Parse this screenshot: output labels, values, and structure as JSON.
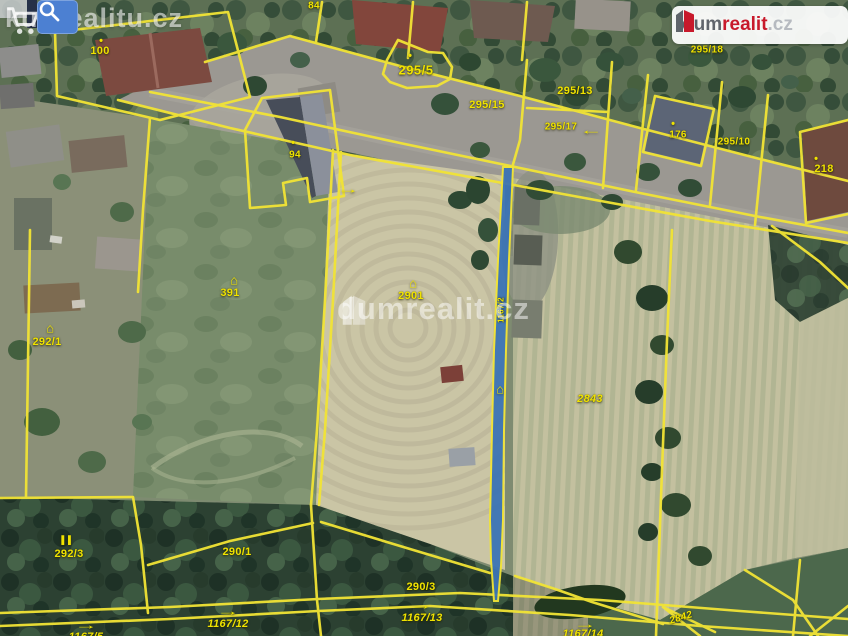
{
  "page": {
    "title": "Cadastral aerial map with parcel overlay"
  },
  "branding": {
    "watermark_top_left": "kuprealitu.cz",
    "watermark_center": "dumrealit.cz",
    "logo": {
      "part_gray": "dum",
      "part_red": "realit",
      "part_tld": ".cz"
    },
    "colors": {
      "logo_red": "#c8192b",
      "logo_gray": "#5f646b",
      "logo_tld_gray": "#b6bac0"
    }
  },
  "toolbar": {
    "search_button": "search"
  },
  "map": {
    "colors": {
      "boundary_yellow": "#f2e435",
      "highlight_blue": "#3c74b5",
      "label_yellow": "#f0e300"
    },
    "highlighted_parcel": "1167/2",
    "symbols": {
      "house": "⌂",
      "dot": "•",
      "arrow_right": "→",
      "arrow_left": "←",
      "forest": "▌▌"
    },
    "labels": {
      "p100": "100",
      "p84": "84",
      "p94": "94",
      "p295_5": "295/5",
      "p295_15": "295/15",
      "p295_13": "295/13",
      "p295_17": "295/17",
      "p295_18": "295/18",
      "p295_10": "295/10",
      "p176": "176",
      "p218": "218",
      "p391": "391",
      "p2901": "2901",
      "p292_1": "292/1",
      "p292_3": "292/3",
      "p290_1": "290/1",
      "p290_3": "290/3",
      "p2843": "2843",
      "p2842": "2842",
      "p1167_12": "1167/12",
      "p1167_13": "1167/13",
      "p1167_14": "1167/14",
      "p1167_5": "1167/5",
      "p1167_2": "1167/2"
    }
  }
}
